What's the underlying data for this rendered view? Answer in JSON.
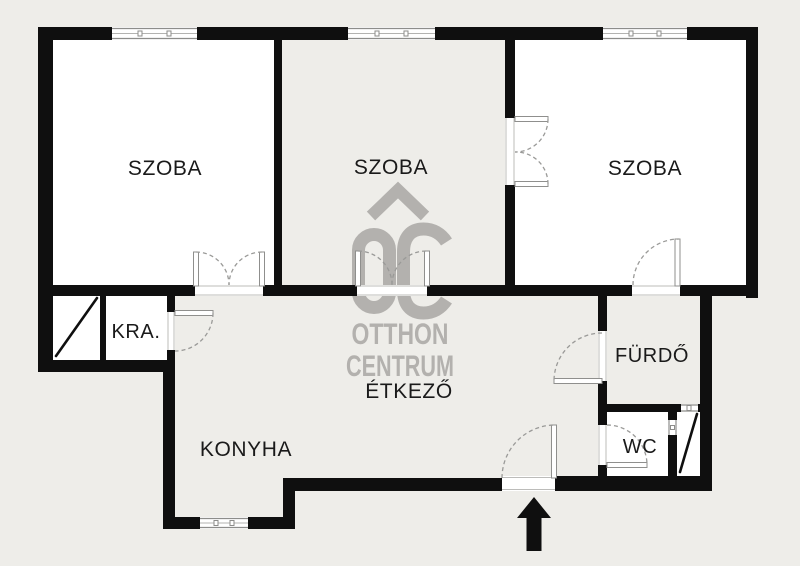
{
  "floor_plan": {
    "labels": {
      "room_left": "SZOBA",
      "room_middle": "SZOBA",
      "room_right": "SZOBA",
      "pantry": "KRA.",
      "kitchen": "KONYHA",
      "dining": "ÉTKEZŐ",
      "bathroom": "FÜRDŐ",
      "wc": "WC"
    },
    "watermark": {
      "name_line1": "OTTHON",
      "name_line2": "CENTRUM",
      "logo": "OC"
    },
    "colors": {
      "background": "#eeede9",
      "room_fill": "#ffffff",
      "wall": "#0f0f0f",
      "watermark": "#b3b1ae",
      "label": "#1a1a1a"
    }
  }
}
